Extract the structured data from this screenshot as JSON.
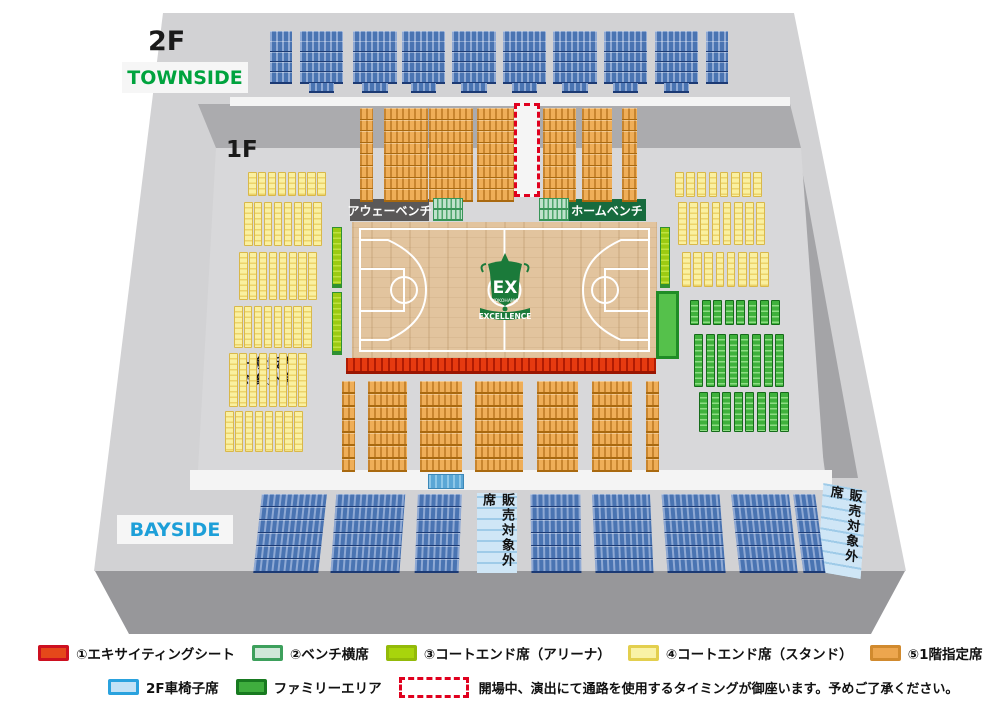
{
  "labels": {
    "floor_2f": "2F",
    "floor_1f": "1F",
    "townside": "TOWNSIDE",
    "bayside": "BAYSIDE",
    "away_bench": "アウェーベンチ",
    "home_bench": "ホームベンチ",
    "general_excluded_line1": "一般販売",
    "general_excluded_line2": "対象外席",
    "excluded_vertical": "販売対象外席",
    "logo_ex": "EX",
    "logo_yokohama": "YOKOHAMA",
    "logo_excellence": "EXCELLENCE"
  },
  "legend": {
    "items": [
      {
        "label": "①エキサイティングシート",
        "fill": "#e5481a",
        "border": "#cd1020"
      },
      {
        "label": "②ベンチ横席",
        "fill": "#cfe7d8",
        "border": "#3da05c"
      },
      {
        "label": "③コートエンド席（アリーナ）",
        "fill": "#a8d40c",
        "border": "#93ba09"
      },
      {
        "label": "④コートエンド席（スタンド）",
        "fill": "#f9f2a6",
        "border": "#e3cf4e"
      },
      {
        "label": "⑤1階指定席",
        "fill": "#eda64e",
        "border": "#d18a2e"
      },
      {
        "label": "⑥2階自由席",
        "fill": "#5b7fba",
        "border": "#2d55a2"
      },
      {
        "label": "2F車椅子席",
        "fill": "#c3e2f6",
        "border": "#2aa2de"
      },
      {
        "label": "ファミリーエリア",
        "fill": "#3fae3e",
        "border": "#187a20"
      }
    ],
    "corridor_border": "#e0001e",
    "note": "開場中、演出にて通路を使用するタイミングが御座います。予めご了承ください。"
  },
  "palettes": {
    "blue": {
      "base": "#4a74b2",
      "stripe": "#8fa9d4",
      "dark": "#1c3a74"
    },
    "orange": {
      "base": "#efae58",
      "stripe": "#c8852f",
      "dark": "#a9690f"
    },
    "red": {
      "base": "#e63a10",
      "stripe": "#b01b03",
      "dark": "#9a1502"
    },
    "yellow": {
      "base": "#faf0a0",
      "stripe": "#ecd36a",
      "dark": "#d9b84a"
    },
    "green": {
      "base": "#3fb13c",
      "stripe": "#8edd84",
      "dark": "#156c1a"
    },
    "mint": {
      "base": "#bfe2cc",
      "stripe": "#4fa56c",
      "dark": "#379457"
    },
    "lightblue": {
      "base": "#cfe6f6",
      "stripe": "#9fcbe8",
      "dark": "#8abede"
    },
    "arena": {
      "base": "#9ccb12",
      "stripe": "#bfe23f",
      "dark": "#2f9132"
    }
  },
  "colors": {
    "building": "#d2d2d4",
    "base3d": "#97979a",
    "wall": "#ababae",
    "right_wall": "#a4a4a7",
    "floor": "#d8d8da",
    "walkway": "#f4f4f4",
    "court_wood": "#e2c49e",
    "court_line": "#ffffff",
    "townside_text": "#00a33e",
    "bayside_text": "#1d9fd8",
    "away_bg": "#5a5858",
    "home_bg": "#176b3e",
    "logo_green": "#1b7a3a",
    "family_block_fill": "#55c14b",
    "family_block_border": "#1f8c26",
    "corridor_bg": "#f5f5f5"
  }
}
